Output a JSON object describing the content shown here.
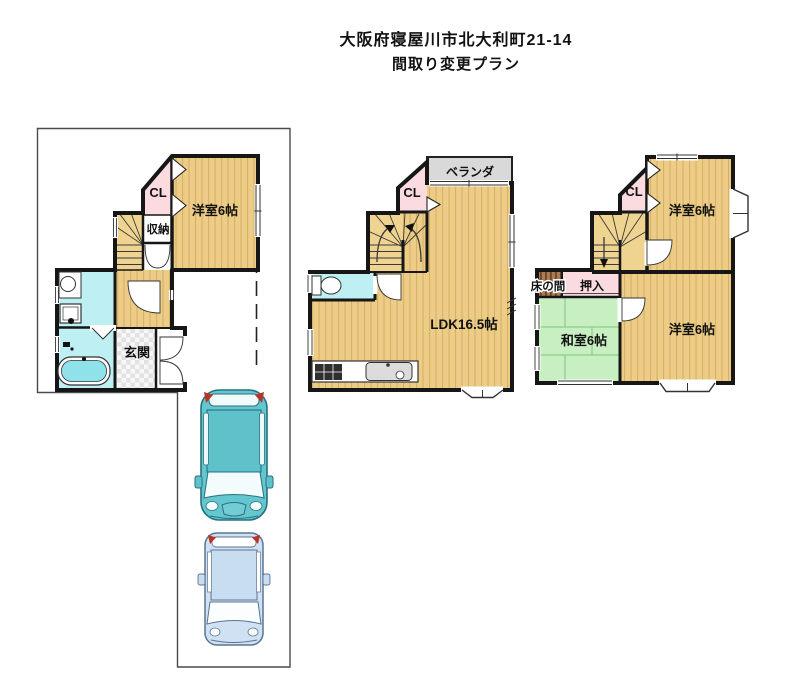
{
  "title": {
    "address_line": "大阪府寝屋川市北大利町21-14",
    "plan_line": "間取り変更プラン"
  },
  "floor1": {
    "closet_label": "CL",
    "storage_label": "収納",
    "western_room_label": "洋室6帖",
    "entrance_label": "玄関"
  },
  "floor2": {
    "veranda_label": "ベランダ",
    "closet_label": "CL",
    "ldk_label": "LDK16.5帖"
  },
  "floor3": {
    "closet_label": "CL",
    "western_room_top_label": "洋室6帖",
    "tokonoma_label": "床の間",
    "oshiire_label": "押入",
    "japanese_room_label": "和室6帖",
    "western_room_bottom_label": "洋室6帖"
  },
  "colors": {
    "floor_wood": "#ECCC86",
    "floor_wood_stripe": "#D6B166",
    "stair_wood": "#EFD491",
    "closet_pink": "#FBDBE0",
    "water_cyan": "#BEEFF2",
    "tatami_green": "#C8EFC2",
    "tatami_line": "#8CCD8C",
    "veranda_gray": "#D9D9D9",
    "tokonoma_brown": "#A97C55",
    "wall_black": "#161616",
    "car_teal": "#64C6CE",
    "car_blue": "#CFE1F3",
    "tail_light_red": "#B83226"
  }
}
